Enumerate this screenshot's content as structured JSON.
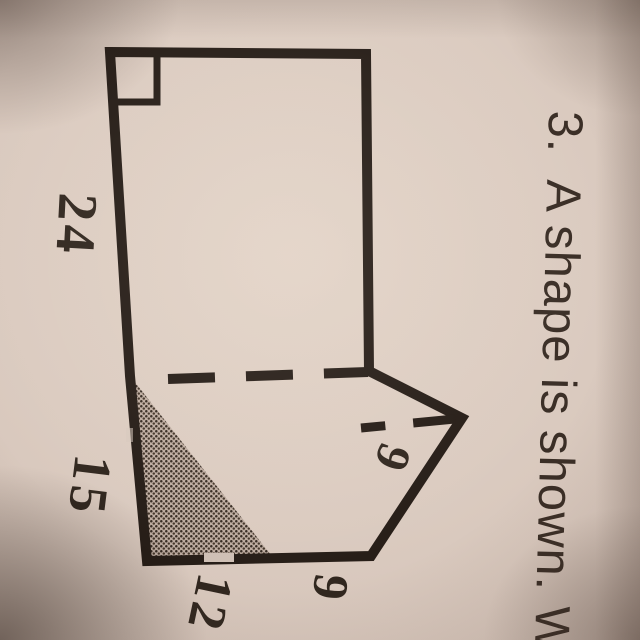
{
  "page": {
    "paper_hex": "#dbcbc0",
    "ink_hex": "#261d17",
    "shade_hex": "#3a2f26"
  },
  "problem": {
    "number": "3.",
    "sentence": "A shape is shown. W"
  },
  "figure": {
    "side_labels": {
      "upper_left": "24",
      "lower_left": "15",
      "bottom_left": "12",
      "bottom_right": "9",
      "dashed_height": "9"
    }
  }
}
